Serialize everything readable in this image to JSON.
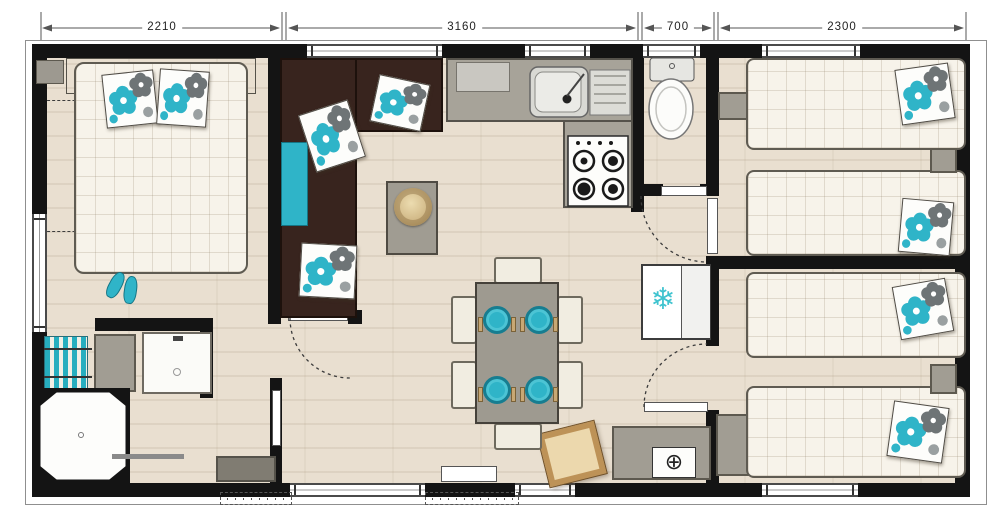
{
  "dimension_line": {
    "segments": [
      {
        "label": "2210"
      },
      {
        "label": "3160"
      },
      {
        "label": "700"
      },
      {
        "label": "2300"
      }
    ]
  },
  "glyphs": {
    "freezer_snowflake": "❄",
    "heater_emblem": "⊕"
  },
  "palette": {
    "accent_teal": "#2fb4c8",
    "sofa_brown": "#38241e",
    "wall_black": "#141414",
    "floor_beige": "#e9dfd0",
    "counter_gray": "#a7a399"
  }
}
